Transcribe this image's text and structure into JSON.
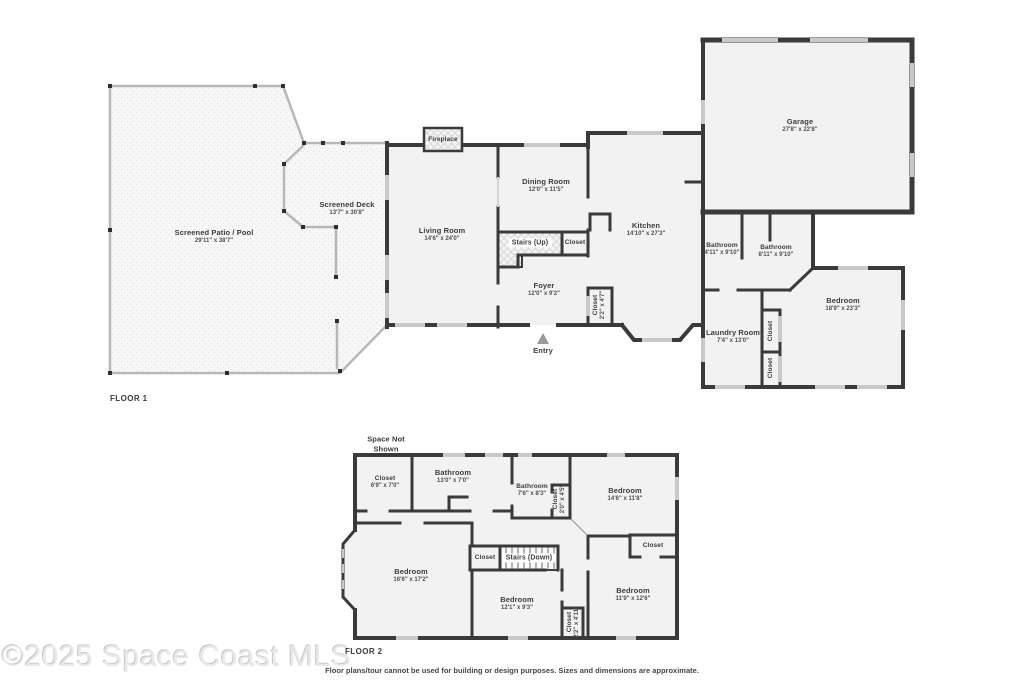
{
  "footer": {
    "watermark": "©2025 Space Coast MLS",
    "disclaimer": "Floor plans/tour cannot be used for building or design purposes. Sizes and dimensions are approximate."
  },
  "colors": {
    "wall": "#3a3a3a",
    "window": "#c9c9c9",
    "room_fill": "#f2f2f2",
    "screen_wall": "#b7b7b7",
    "text": "#3c3c3c"
  },
  "floor1": {
    "tag": "FLOOR 1",
    "rooms": {
      "patio": {
        "name": "Screened Patio / Pool",
        "dims": "29'11\" x 38'7\""
      },
      "deck": {
        "name": "Screened Deck",
        "dims": "13'7\" x 30'8\""
      },
      "living": {
        "name": "Living Room",
        "dims": "14'6\" x 24'0\""
      },
      "dining": {
        "name": "Dining Room",
        "dims": "12'0\" x 11'5\""
      },
      "kitchen": {
        "name": "Kitchen",
        "dims": "14'10\" x 27'3\""
      },
      "foyer": {
        "name": "Foyer",
        "dims": "12'0\" x 9'2\""
      },
      "stairs": {
        "name": "Stairs (Up)"
      },
      "stairs_closet": {
        "name": "Closet"
      },
      "foyer_closet": {
        "name": "Closet",
        "dims": "2'2\" x 4'7\""
      },
      "garage": {
        "name": "Garage",
        "dims": "27'8\" x 22'8\""
      },
      "bathroom_small": {
        "name": "Bathroom",
        "dims": "4'11\" x 9'10\""
      },
      "bathroom_large": {
        "name": "Bathroom",
        "dims": "8'11\" x 9'10\""
      },
      "bedroom": {
        "name": "Bedroom",
        "dims": "18'9\" x 23'3\""
      },
      "laundry": {
        "name": "Laundry Room",
        "dims": "7'4\" x 13'0\""
      },
      "closet_a": {
        "name": "Closet"
      },
      "closet_b": {
        "name": "Closet"
      },
      "fireplace": {
        "name": "Fireplace"
      },
      "entry": {
        "name": "Entry"
      }
    }
  },
  "floor2": {
    "tag": "FLOOR 2",
    "space_not_shown": "Space Not Shown",
    "rooms": {
      "closet_top_left": {
        "name": "Closet",
        "dims": "6'9\" x 7'0\""
      },
      "bathroom_long": {
        "name": "Bathroom",
        "dims": "13'0\" x 7'0\""
      },
      "bathroom_small": {
        "name": "Bathroom",
        "dims": "7'6\" x 8'3\""
      },
      "bathroom_closet": {
        "name": "Closet",
        "dims": "2'0\" x 4'5\""
      },
      "bedroom_ne": {
        "name": "Bedroom",
        "dims": "14'6\" x 11'8\""
      },
      "closet_top_right": {
        "name": "Closet"
      },
      "bedroom_w": {
        "name": "Bedroom",
        "dims": "16'6\" x 17'2\""
      },
      "stairs_closet": {
        "name": "Closet"
      },
      "stairs": {
        "name": "Stairs (Down)"
      },
      "bedroom_s": {
        "name": "Bedroom",
        "dims": "12'1\" x 9'3\""
      },
      "hall_closet": {
        "name": "Closet",
        "dims": "2'2\" x 4'11\""
      },
      "bedroom_se": {
        "name": "Bedroom",
        "dims": "11'9\" x 12'6\""
      }
    }
  }
}
